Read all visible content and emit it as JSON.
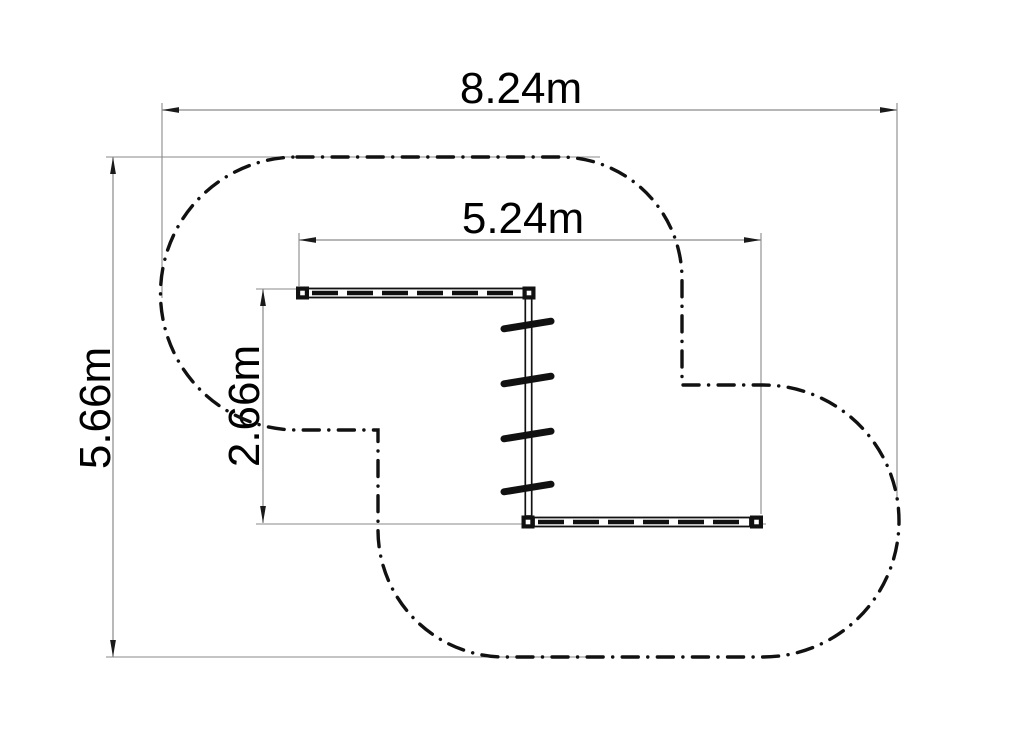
{
  "page": {
    "background": "#ffffff"
  },
  "drawing": {
    "kind": "plan-view technical drawing of gymnastics wall-bar equipment with dash-dot safety-zone boundary",
    "colors": {
      "outline": "#111111",
      "dimension_line": "#8a8a8a",
      "arrowhead": "#1a1a1a",
      "label_text": "#000000",
      "background": "#ffffff"
    },
    "dimensions": {
      "overall_width": {
        "label": "8.24m",
        "value": 8.24,
        "unit": "m",
        "orientation": "horizontal",
        "measures": "overall safety-zone width"
      },
      "overall_height": {
        "label": "5.66m",
        "value": 5.66,
        "unit": "m",
        "orientation": "vertical",
        "measures": "overall safety-zone height"
      },
      "inner_width": {
        "label": "5.24m",
        "value": 5.24,
        "unit": "m",
        "orientation": "horizontal",
        "measures": "equipment width"
      },
      "inner_height": {
        "label": "2.66m",
        "value": 2.66,
        "unit": "m",
        "orientation": "vertical",
        "measures": "equipment height"
      }
    },
    "equipment": {
      "rung_count": 4
    }
  }
}
